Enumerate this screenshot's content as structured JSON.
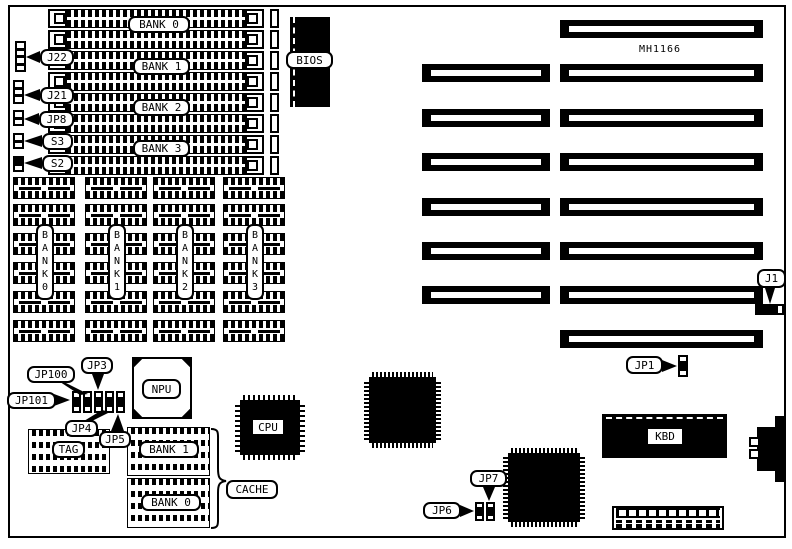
{
  "colors": {
    "ink": "#000000",
    "paper": "#ffffff"
  },
  "chipset": {
    "label": "MH1166"
  },
  "simm_area": {
    "slot_count": 8,
    "bank_labels": [
      "BANK 0",
      "BANK 1",
      "BANK 2",
      "BANK 3"
    ],
    "left_connectors": [
      {
        "label": "J22"
      },
      {
        "label": "J21"
      },
      {
        "label": "JP8"
      },
      {
        "label": "S3"
      },
      {
        "label": "S2"
      }
    ]
  },
  "bios": {
    "label": "BIOS"
  },
  "isa_slots": {
    "long_count": 8,
    "short_count": 6
  },
  "dram_area": {
    "rows": 6,
    "cols": 4,
    "bank_labels": [
      "B A N K 0",
      "B A N K 1",
      "B A N K 2",
      "B A N K 3"
    ]
  },
  "npu": {
    "label": "NPU"
  },
  "cpu": {
    "label": "CPU"
  },
  "kbd": {
    "label": "KBD"
  },
  "cache_area": {
    "tag_label": "TAG",
    "bank1_label": "BANK 1",
    "bank0_label": "BANK 0",
    "cache_label": "CACHE"
  },
  "callouts": {
    "jp100": "JP100",
    "jp3": "JP3",
    "jp101": "JP101",
    "jp4": "JP4",
    "jp5": "JP5",
    "jp6": "JP6",
    "jp7": "JP7",
    "jp1": "JP1",
    "j1": "J1"
  },
  "headers": {
    "j22": {
      "pins": 4,
      "filled": [],
      "orient": "v"
    },
    "j21": {
      "pins": 3,
      "filled": [],
      "orient": "v"
    },
    "jp8": {
      "pins": 2,
      "filled": [],
      "orient": "v"
    },
    "s3": {
      "pins": 2,
      "filled": [],
      "orient": "v"
    },
    "s2": {
      "pins": 2,
      "filled": [
        0
      ],
      "orient": "v"
    },
    "jp101h": {
      "pins": 3,
      "filled": [
        1
      ],
      "orient": "v"
    },
    "jp100h": {
      "pins": 3,
      "filled": [
        1
      ],
      "orient": "v"
    },
    "jp3h": {
      "pins": 3,
      "filled": [
        1
      ],
      "orient": "v"
    },
    "jp4h": {
      "pins": 3,
      "filled": [
        1
      ],
      "orient": "v"
    },
    "jp5h": {
      "pins": 3,
      "filled": [
        1
      ],
      "orient": "v"
    },
    "jp6h": {
      "pins": 3,
      "filled": [
        1
      ],
      "orient": "v"
    },
    "jp7h": {
      "pins": 3,
      "filled": [
        1
      ],
      "orient": "v"
    },
    "jp1h": {
      "pins": 3,
      "filled": [
        1
      ],
      "orient": "v"
    },
    "j1h": {
      "pins": 4,
      "filled": [
        0,
        1,
        2
      ],
      "orient": "h"
    }
  }
}
